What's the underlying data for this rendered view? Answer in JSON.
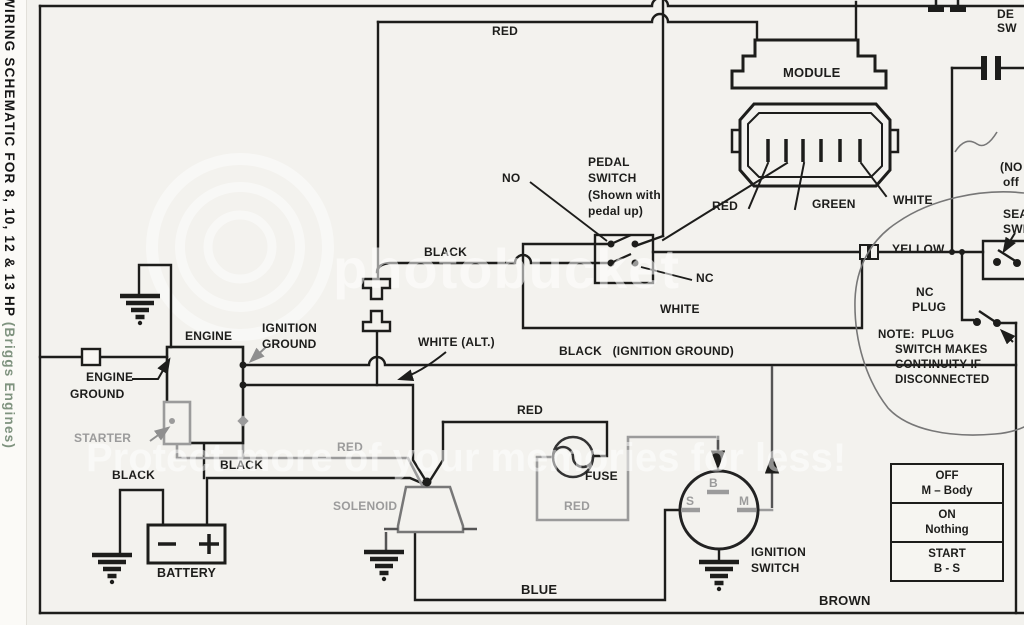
{
  "page": {
    "side_title_main": "WIRING SCHEMATIC FOR 8, 10, 12 & 13 HP ",
    "side_title_paren": "(Briggs Engines)"
  },
  "watermark": {
    "brand": "photobucket",
    "tagline": "Protect more of your memories for less!"
  },
  "wires": {
    "red_top": "RED",
    "black_pedal": "BLACK",
    "white_lower": "WHITE",
    "yellow": "YELLOW",
    "white_alt": "WHITE (ALT.)",
    "black_ignition_ground": "BLACK   (IGNITION GROUND)",
    "red_starter": "RED",
    "red_fuse_top": "RED",
    "red_fuse_loop": "RED",
    "black_battery_ground": "BLACK",
    "black_battery_feed": "BLACK",
    "blue": "BLUE",
    "brown": "BROWN"
  },
  "module": {
    "label": "MODULE",
    "pin_red": "RED",
    "pin_green": "GREEN",
    "pin_white": "WHITE"
  },
  "pedal_switch": {
    "l1": "PEDAL",
    "l2": "SWITCH",
    "l3": "(Shown with",
    "l4": "pedal up)",
    "no": "NO",
    "nc": "NC"
  },
  "engine": {
    "label": "ENGINE",
    "engine_ground_l1": "ENGINE",
    "engine_ground_l2": "GROUND",
    "ignition_ground_l1": "IGNITION",
    "ignition_ground_l2": "GROUND",
    "starter": "STARTER"
  },
  "power": {
    "battery": "BATTERY",
    "solenoid": "SOLENOID",
    "fuse": "FUSE"
  },
  "ignition_switch": {
    "l1": "IGNITION",
    "l2": "SWITCH",
    "b": "B",
    "s": "S",
    "m": "M"
  },
  "seat_area": {
    "nc_plug_l1": "NC",
    "nc_plug_l2": "PLUG",
    "note_l1": "NOTE:  PLUG",
    "note_l2": "SWITCH MAKES",
    "note_l3": "CONTINUITY IF",
    "note_l4": "DISCONNECTED",
    "edge_deck_l1": "DE",
    "edge_deck_l2": "SW",
    "edge_no_l1": "(NO",
    "edge_no_l2": "off",
    "edge_seat_l1": "SEA",
    "edge_seat_l2": "SWI"
  },
  "legend_table": {
    "rows": [
      [
        "OFF",
        "M – Body"
      ],
      [
        "ON",
        "Nothing"
      ],
      [
        "START",
        "B - S"
      ]
    ]
  },
  "colors": {
    "ink": "#1d1d1b",
    "gray_wire": "#9b9b9b",
    "paper": "#f3f2ee"
  }
}
